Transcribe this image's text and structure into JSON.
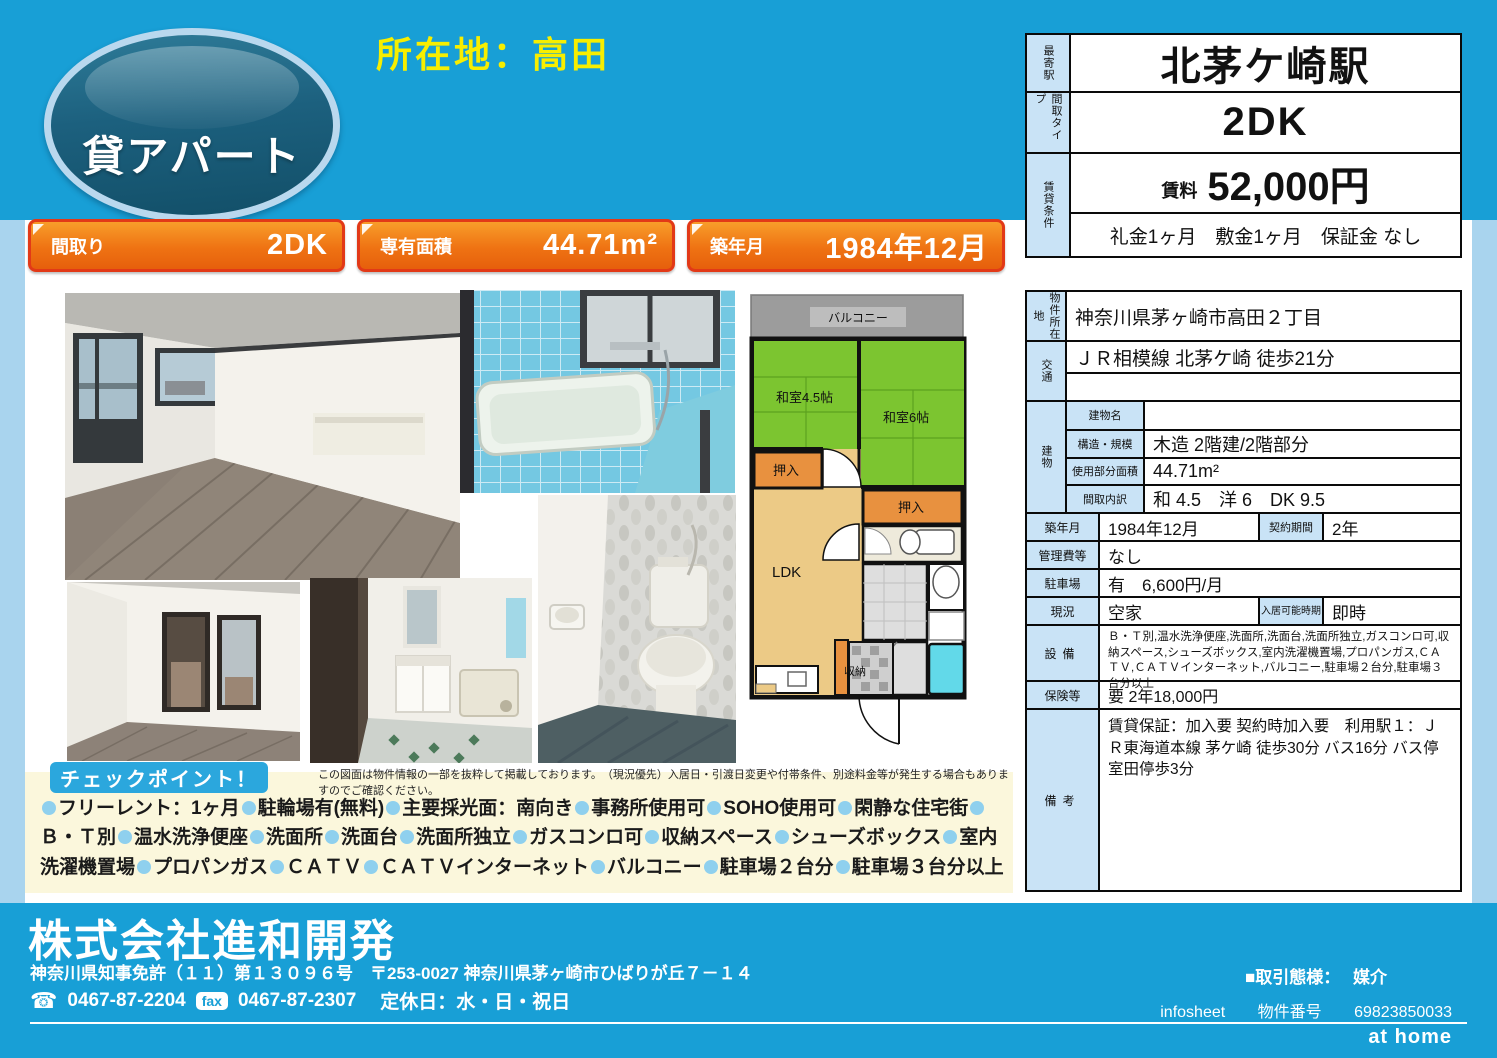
{
  "colors": {
    "band": "#189fd6",
    "side_strip": "#a9d4ee",
    "banner_border": "#e23917",
    "label_cell": "#c9e3f6",
    "cream": "#fbf7dc",
    "tatami": "#7cc530",
    "closet": "#e8913f",
    "ldk": "#ecca86",
    "bath": "#62d9e9"
  },
  "header": {
    "badge_label": "貸アパート",
    "location_title": "所在地：高田",
    "station_table": {
      "row1_label": "最寄駅",
      "row1_value": "北茅ケ崎駅",
      "row2_label": "間取タイプ",
      "row2_value": "2DK",
      "row3_label": "賃貸条件",
      "rent_label": "賃料",
      "rent_value": "52,000円",
      "terms": "礼金1ヶ月　敷金1ヶ月　保証金 なし"
    }
  },
  "banners": [
    {
      "label": "間取り",
      "value": "2DK"
    },
    {
      "label": "専有面積",
      "value": "44.71m²"
    },
    {
      "label": "築年月",
      "value": "1984年12月"
    }
  ],
  "floorplan": {
    "balcony": "バルコニー",
    "tatami45": "和室4.5帖",
    "tatami6": "和室6帖",
    "closet_left": "押入",
    "closet_right": "押入",
    "ldk": "LDK",
    "storage": "収納"
  },
  "details": {
    "location": {
      "label": "物件所在地",
      "value": "神奈川県茅ヶ崎市高田２丁目"
    },
    "transport": {
      "label": "交通",
      "value": "ＪＲ相模線 北茅ケ崎 徒歩21分",
      "value2": ""
    },
    "building": {
      "label": "建物",
      "rows": [
        {
          "label": "建物名",
          "value": ""
        },
        {
          "label": "構造・規模",
          "value": "木造 2階建/2階部分"
        },
        {
          "label": "使用部分面積",
          "value": "44.71m²"
        },
        {
          "label": "間取内訳",
          "value": "和 4.5　洋 6　DK 9.5"
        }
      ]
    },
    "built": {
      "label": "築年月",
      "value": "1984年12月",
      "label2": "契約期間",
      "value2": "2年"
    },
    "management": {
      "label": "管理費等",
      "value": "なし"
    },
    "parking": {
      "label": "駐車場",
      "value": "有　6,600円/月"
    },
    "status": {
      "label": "現況",
      "value": "空家",
      "label2": "入居可能時期",
      "value2": "即時"
    },
    "equipment": {
      "label": "設備",
      "value": "Ｂ・Ｔ別,温水洗浄便座,洗面所,洗面台,洗面所独立,ガスコンロ可,収納スペース,シューズボックス,室内洗濯機置場,プロパンガス,ＣＡＴＶ,ＣＡＴＶインターネット,バルコニー,駐車場２台分,駐車場３台分以上"
    },
    "insurance": {
      "label": "保険等",
      "value": "要 2年18,000円"
    },
    "remarks": {
      "label": "備考",
      "value": "賃貸保証：加入要 契約時加入要　利用駅１：ＪＲ東海道本線 茅ケ崎 徒歩30分 バス16分 バス停 室田停歩3分"
    }
  },
  "checkpoints": {
    "button_label": "チェックポイント！",
    "disclaimer": "この図面は物件情報の一部を抜粋して掲載しております。　（現況優先）入居日・引渡日変更や付帯条件、別途料金等が発生する場合もありますのでご確認ください。",
    "items": [
      "フリーレント：1ヶ月",
      "駐輪場有(無料)",
      "主要採光面：南向き",
      "事務所使用可",
      "SOHO使用可",
      "閑静な住宅街",
      "Ｂ・Ｔ別",
      "温水洗浄便座",
      "洗面所",
      "洗面台",
      "洗面所独立",
      "ガスコンロ可",
      "収納スペース",
      "シューズボックス",
      "室内洗濯機置場",
      "プロパンガス",
      "ＣＡＴＶ",
      "ＣＡＴＶインターネット",
      "バルコニー",
      "駐車場２台分",
      "駐車場３台分以上"
    ]
  },
  "footer": {
    "company": "株式会社進和開発",
    "license": "神奈川県知事免許（１１）第１３０９６号　〒253-0027 神奈川県茅ヶ崎市ひばりが丘７－１４",
    "tel_icon": "☎",
    "tel": "0467-87-2204",
    "fax_label": "fax",
    "fax": "0467-87-2307",
    "holiday": "定休日：水・日・祝日",
    "deal_type_label": "■取引態様：",
    "deal_type": "媒介",
    "infosheet": "infosheet",
    "property_no_label": "物件番号",
    "property_no": "69823850033",
    "logo": "at home"
  }
}
